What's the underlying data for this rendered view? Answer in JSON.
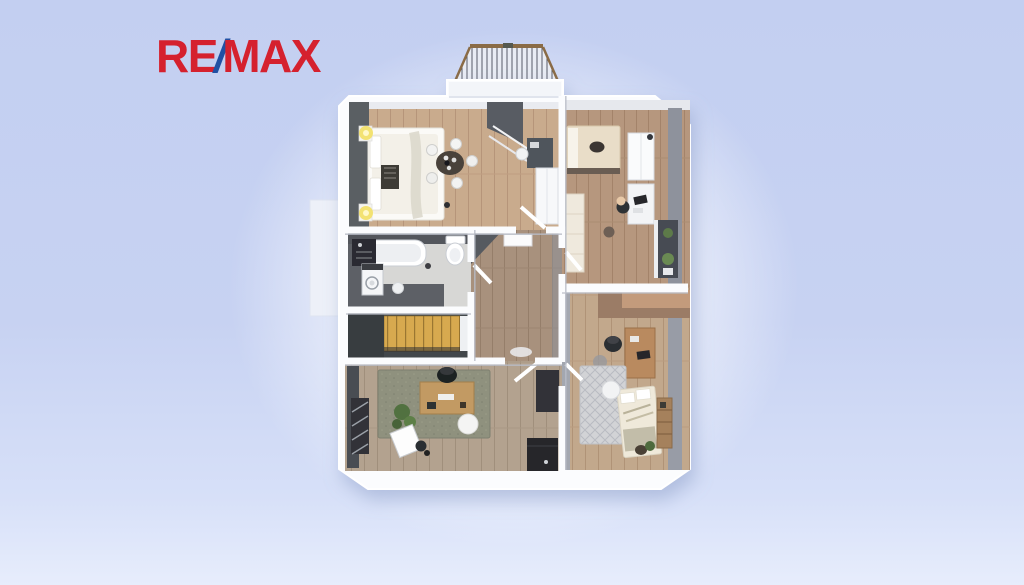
{
  "page": {
    "title": "RE/MAX apartment 3D floor plan rendering",
    "background_top": "#c3cff1",
    "background_bottom": "#e7edfc"
  },
  "logo": {
    "re": "RE",
    "slash": "/",
    "max": "MAX"
  },
  "colors": {
    "logo-red": "#d5212e",
    "logo-blue": "#2150a3",
    "wall-white": "#fbfcfe",
    "wall-face-gray": "#8e929c",
    "wall-face-dark": "#5a5e64",
    "wood-light": "#c9ab8d",
    "wood-mid": "#b6977e",
    "wood-hall": "#a8917d",
    "wood-gray": "#b3a28f",
    "wood-tan": "#c2a88c",
    "bath-tile-light": "#d7d7d5",
    "bath-tile-dark": "#5d6066",
    "stairs-wood": "#d7a94f",
    "rug-green": "#8f917e",
    "rug-pattern": "#d2d3d6",
    "plant-green": "#55743f",
    "lamp-yellow": "#f2e06a",
    "railing-brown": "#8a6b46"
  },
  "floor_plan": {
    "type": "3d-top-down-rendering",
    "rooms": [
      "master-bedroom-with-dining",
      "kids-bedroom",
      "bathroom",
      "hallway",
      "staircase",
      "home-office",
      "second-bedroom"
    ],
    "features": [
      "balcony-with-railing",
      "side-terrace"
    ]
  }
}
